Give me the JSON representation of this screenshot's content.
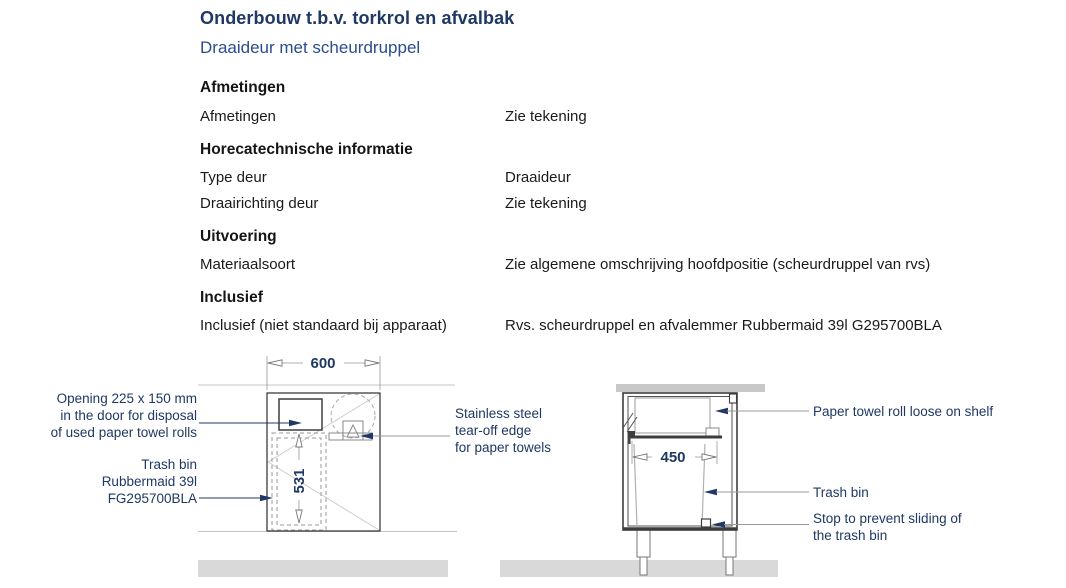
{
  "header": {
    "title": "Onderbouw t.b.v. torkrol en afvalbak",
    "subtitle": "Draaideur met scheurdruppel"
  },
  "specs": {
    "sections": [
      {
        "heading": "Afmetingen",
        "rows": [
          {
            "label": "Afmetingen",
            "value": "Zie tekening"
          }
        ]
      },
      {
        "heading": "Horecatechnische informatie",
        "rows": [
          {
            "label": "Type deur",
            "value": "Draaideur"
          },
          {
            "label": "Draairichting deur",
            "value": "Zie tekening"
          }
        ]
      },
      {
        "heading": "Uitvoering",
        "rows": [
          {
            "label": "Materiaalsoort",
            "value": "Zie algemene omschrijving hoofdpositie (scheurdruppel van rvs)"
          }
        ]
      },
      {
        "heading": "Inclusief",
        "rows": [
          {
            "label": "Inclusief (niet standaard bij apparaat)",
            "value": "Rvs. scheurdruppel en afvalemmer Rubbermaid 39l G295700BLA"
          }
        ]
      }
    ]
  },
  "drawings": {
    "front_view": {
      "width_dim": "600",
      "bin_depth_dim": "531",
      "annotations": {
        "opening": [
          "Opening 225 x 150 mm",
          "in the door for disposal",
          "of used paper towel rolls"
        ],
        "trash_bin": [
          "Trash bin",
          "Rubbermaid 39l",
          "FG295700BLA"
        ],
        "tear_off": [
          "Stainless steel",
          "tear-off edge",
          "for paper towels"
        ]
      }
    },
    "side_view": {
      "bin_width_dim": "450",
      "annotations": {
        "roll": "Paper towel roll loose on shelf",
        "trash_bin": "Trash bin",
        "stop": [
          "Stop to prevent sliding of",
          "the trash bin"
        ]
      }
    }
  },
  "colors": {
    "title_navy": "#1f3864",
    "subtitle_blue": "#2a4d8f",
    "body_text": "#1a1a1a",
    "floor_gray": "#d9d9d9",
    "worktop_gray": "#c8c8c8",
    "dimension_navy": "#1f3864"
  }
}
